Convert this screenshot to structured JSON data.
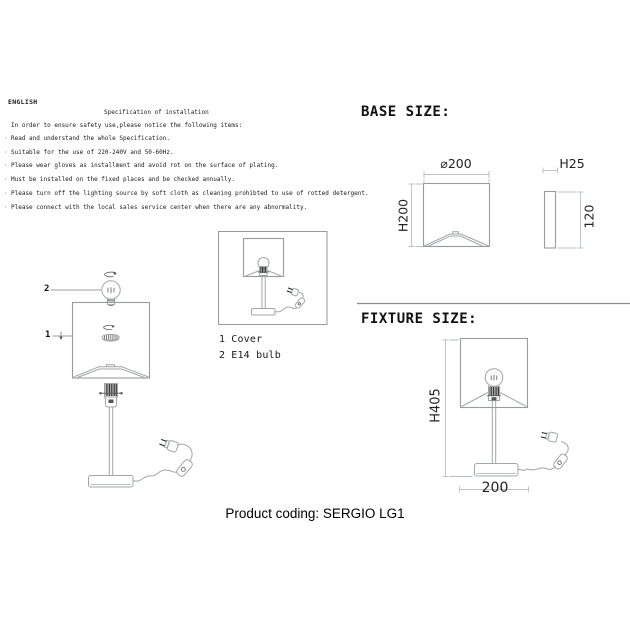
{
  "language_label": "ENGLISH",
  "spec": {
    "title": "Specification of installation",
    "intro": "In order to ensure safety use,please notice the following items:",
    "bullet": "·",
    "items": [
      "Read and understand the whole Specification.",
      "Suitable for the use of 220-240V and 50-60Hz.",
      "Please wear gloves as installment and avoid rot on the surface of plating.",
      "Must be installed on the fixed places and be checked annually.",
      "Please turn off the lighting source by soft cloth as cleaning prohibted to use of rotted detergent.",
      "Please connect with the local sales service center when there are any abnormality."
    ]
  },
  "exploded_labels": {
    "bulb_num": "2",
    "cover_num": "1"
  },
  "legend": {
    "items": [
      {
        "num": "1",
        "label": "Cover"
      },
      {
        "num": "2",
        "label": "E14 bulb"
      }
    ]
  },
  "base_size": {
    "heading": "BASE SIZE:",
    "front": {
      "width": "⌀200",
      "height": "H200"
    },
    "side": {
      "width": "H25",
      "height": "120"
    }
  },
  "fixture_size": {
    "heading": "FIXTURE SIZE:",
    "height": "H405",
    "width": "200"
  },
  "footer": {
    "product_coding": "Product coding: SERGIO LG1"
  },
  "colors": {
    "background": "#ffffff",
    "drawing_line": "#a2a6a8",
    "dimension_line": "#b9bfc2",
    "dark_detail": "#2f2f2f",
    "text": "#1a1a1a"
  }
}
